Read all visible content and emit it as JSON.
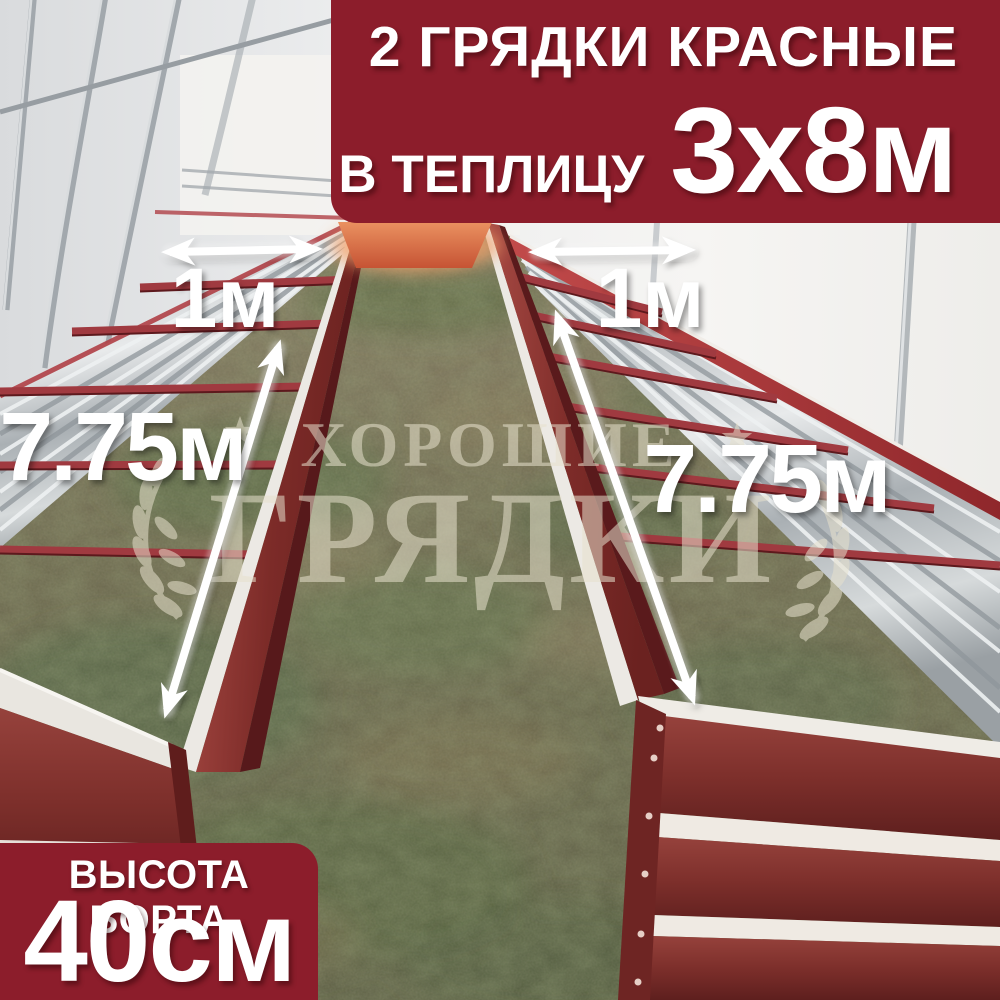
{
  "product_banner": {
    "line1": "2 ГРЯДКИ КРАСНЫЕ",
    "line2_label": "В ТЕПЛИЦУ",
    "line2_value": "3х8м",
    "bg_color": "#8c1d2b",
    "text_color": "#ffffff"
  },
  "height_banner": {
    "line1": "ВЫСОТА БОРТА",
    "line2": "40см",
    "bg_color": "#8c1d2b",
    "text_color": "#ffffff"
  },
  "measurements": {
    "left_bed_width": "1м",
    "right_bed_width": "1м",
    "left_bed_length": "7.75м",
    "right_bed_length": "7.75м"
  },
  "watermark": {
    "line1": "ХОРОШИЕ",
    "line2": "ГРЯДКИ",
    "color": "#e7e1cd"
  },
  "scene": {
    "bed_color": "#8a2f2c",
    "bed_trim_color": "#efece6",
    "galvanized_color": "#c6cbce",
    "ground_green": "#5c6b42",
    "ground_brown": "#7b6f55",
    "arrow_color": "#ffffff"
  }
}
